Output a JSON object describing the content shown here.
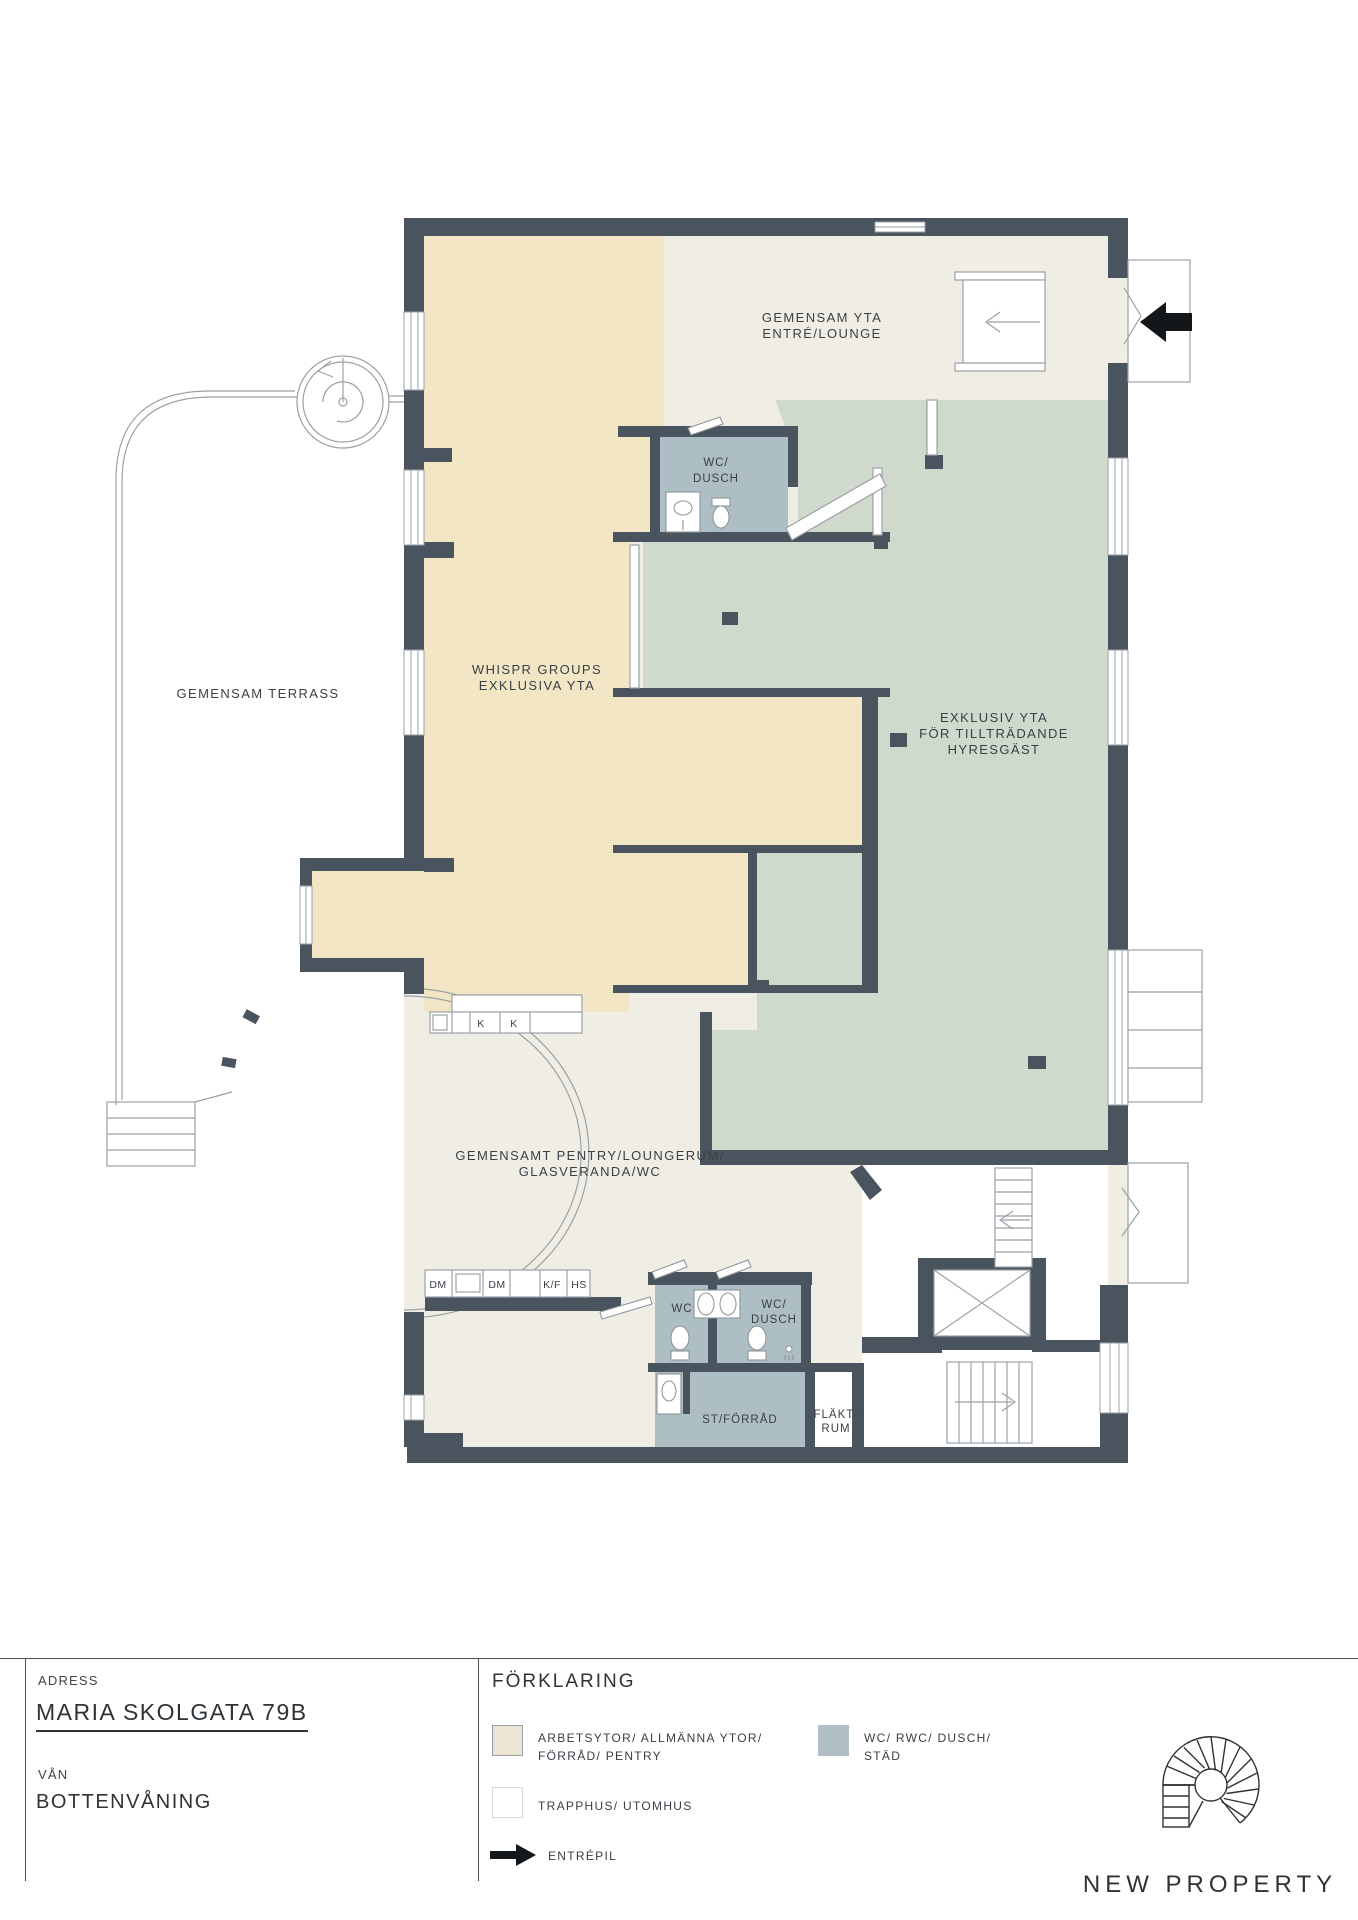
{
  "plan": {
    "labels": {
      "terrass": "GEMENSAM TERRASS",
      "entre": [
        "GEMENSAM YTA",
        "ENTRÉ/LOUNGE"
      ],
      "whispr": [
        "WHISPR GROUPS",
        "EXKLUSIVA YTA"
      ],
      "exklusiv": [
        "EXKLUSIV YTA",
        "FÖR TILLTRÄDANDE",
        "HYRESGÄST"
      ],
      "wc_dusch_upper": [
        "WC/",
        "DUSCH"
      ],
      "pentry": [
        "GEMENSAMT PENTRY/LOUNGERUM/",
        "GLASVERANDA/WC"
      ],
      "wc_lower": "WC",
      "wc_dusch_lower": [
        "WC/",
        "DUSCH"
      ],
      "st_forrad": "ST/FÖRRÅD",
      "flaktrum": [
        "FLÄKT-",
        "RUM"
      ],
      "counter_top": {
        "k1": "K",
        "k2": "K"
      },
      "counter_bottom": {
        "dm1": "DM",
        "dm2": "DM",
        "kf": "K/F",
        "hs": "HS"
      }
    },
    "colors": {
      "wall": "#4A545E",
      "workspace_beige": "#F2E6C5",
      "common_offwhite": "#F0EDE4",
      "exclusive_green": "#CFDACD",
      "wet_gray": "#ADBEC5",
      "thin_line": "#8F959A",
      "arrow_black": "#14171A"
    }
  },
  "titleblock": {
    "address_label": "ADRESS",
    "address_value": "MARIA SKOLGATA 79B",
    "floor_label": "VÅN",
    "floor_value": "BOTTENVÅNING"
  },
  "legend": {
    "title": "FÖRKLARING",
    "items": [
      {
        "swatch": "#ECE5D4",
        "lines": [
          "ARBETSYTOR/ ALLMÄNNA YTOR/",
          "FÖRRÅD/ PENTRY"
        ]
      },
      {
        "swatch": "#B0BFC5",
        "lines": [
          "WC/ RWC/ DUSCH/",
          "STÄD"
        ]
      },
      {
        "swatch": "#FFFFFF",
        "lines": [
          "TRAPPHUS/ UTOMHUS"
        ]
      },
      {
        "swatch": "arrow",
        "lines": [
          "ENTRÉPIL"
        ]
      }
    ]
  },
  "logo": {
    "text": "NEW PROPERTY"
  }
}
